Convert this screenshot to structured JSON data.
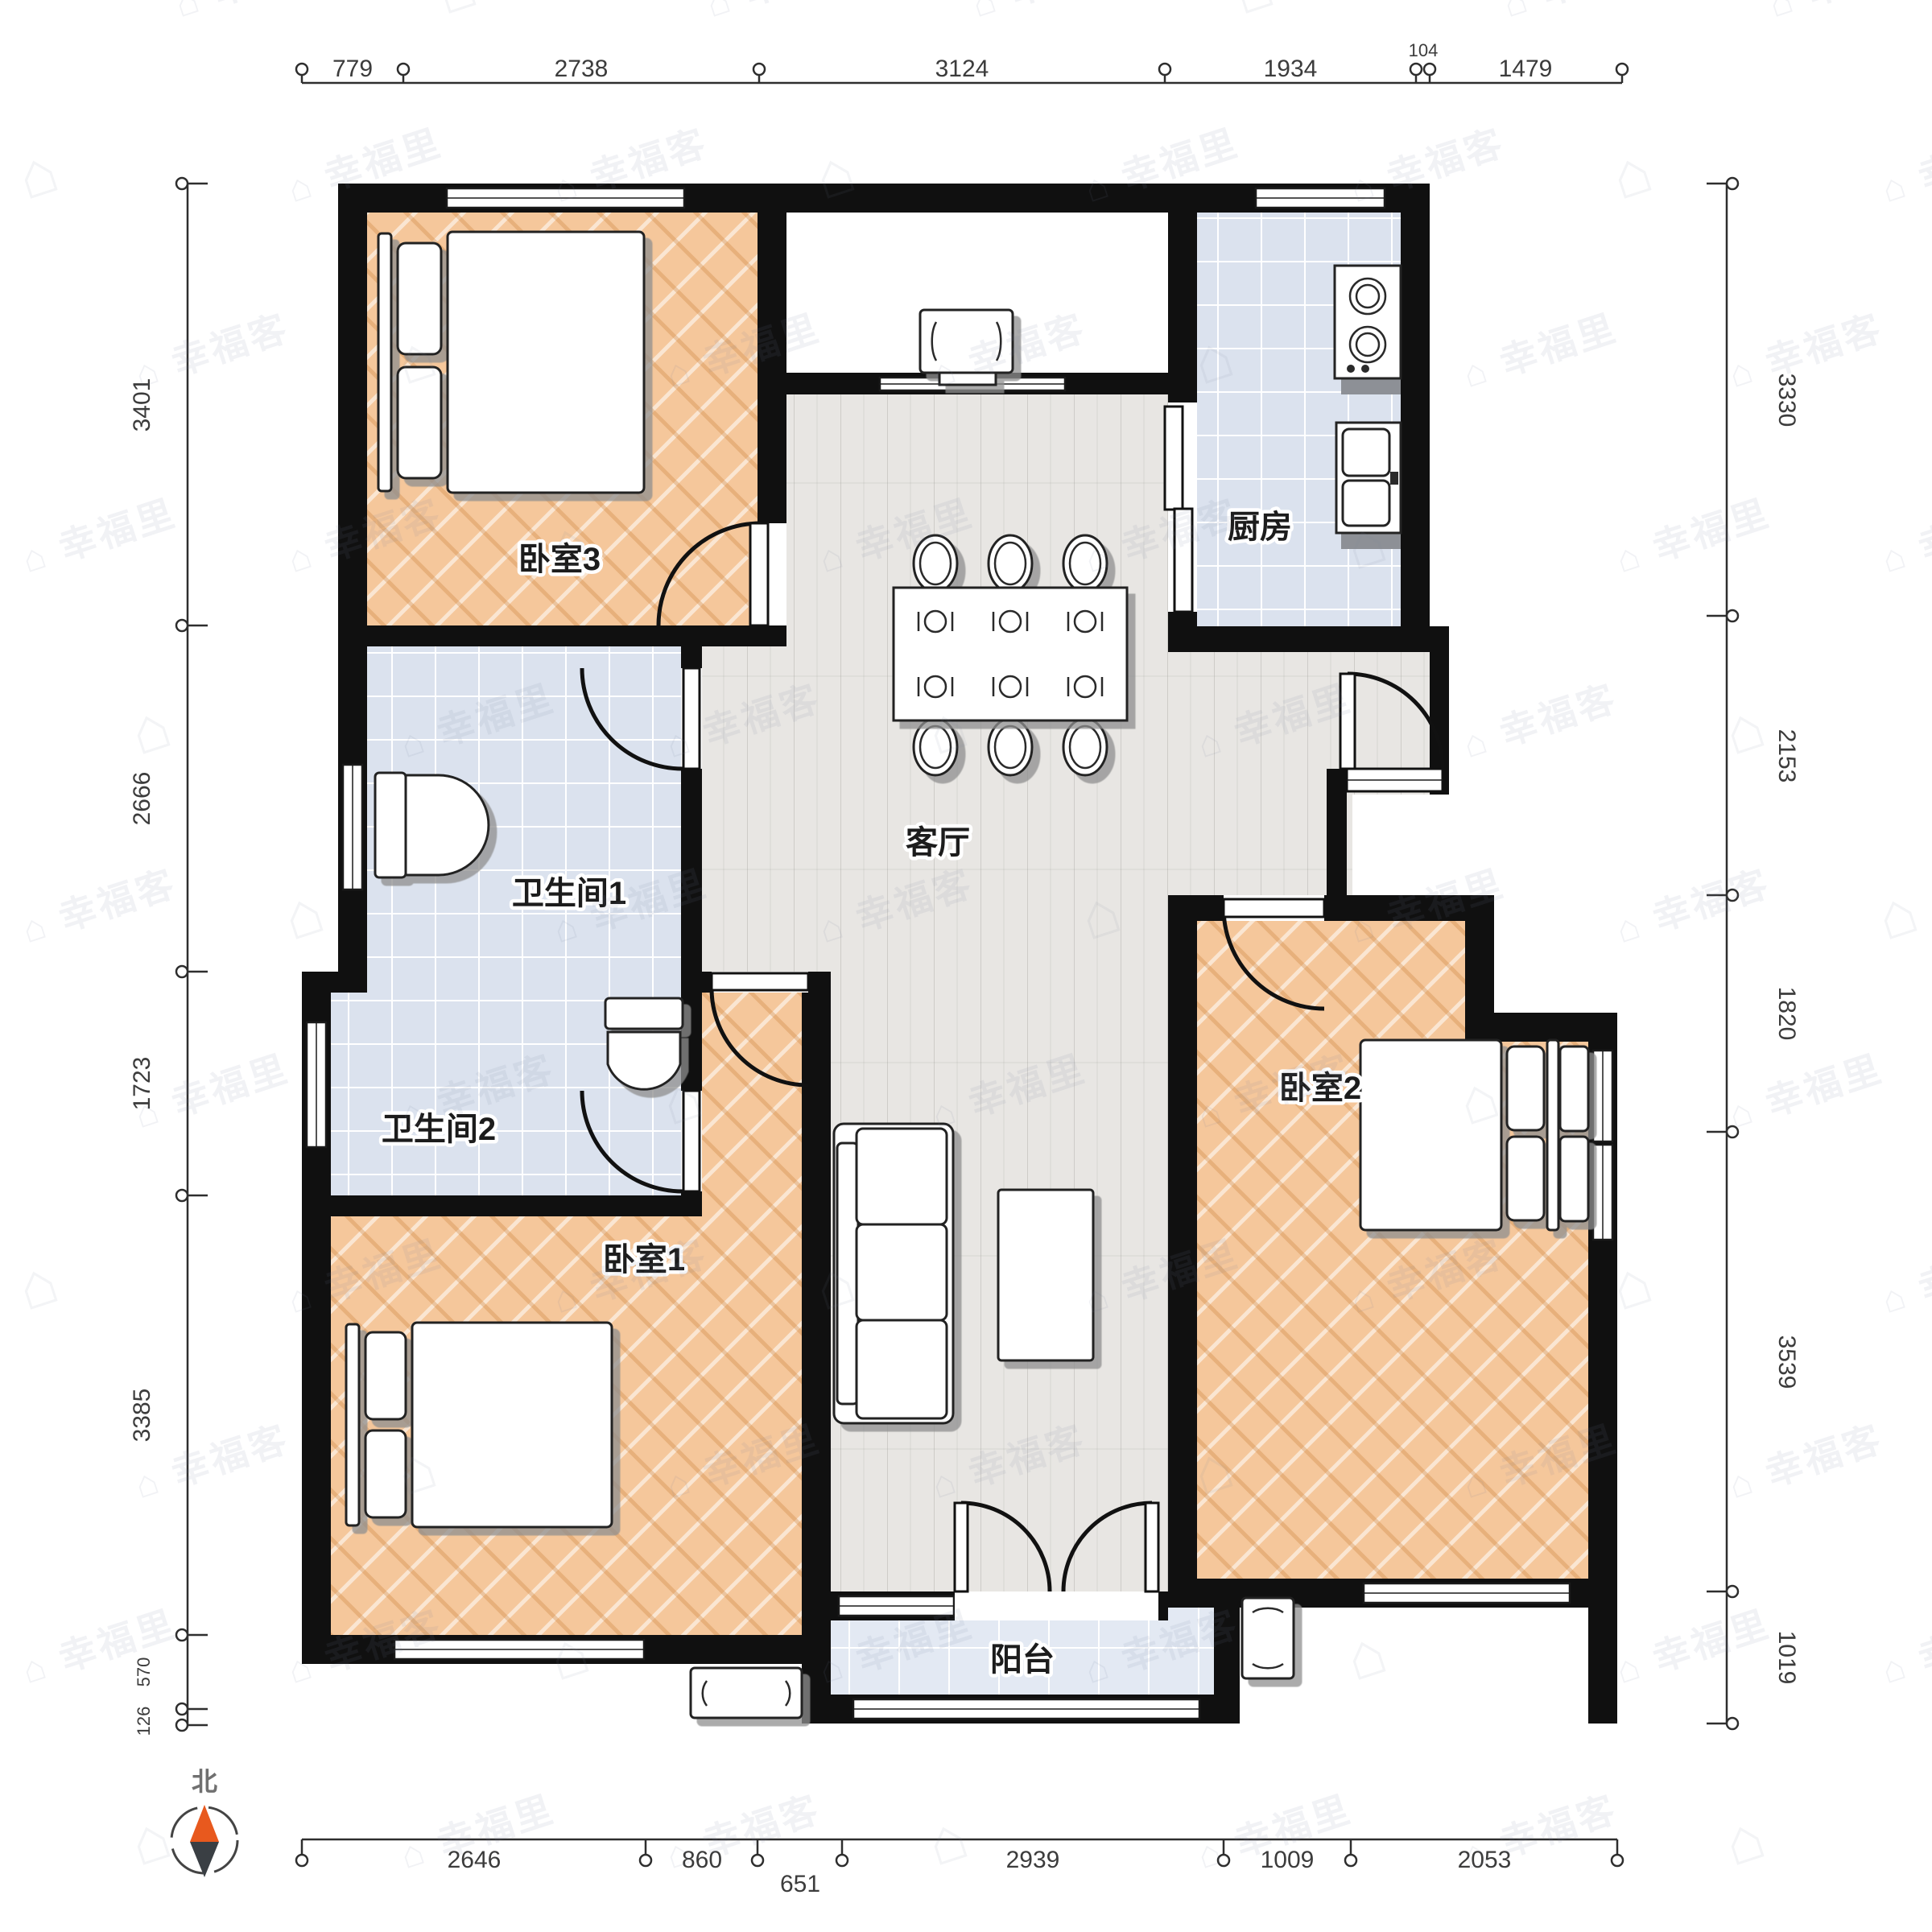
{
  "plan_type": "apartment-floor-plan",
  "rooms": {
    "bedroom3": {
      "label": "卧室3"
    },
    "kitchen": {
      "label": "厨房"
    },
    "bathroom1": {
      "label": "卫生间1"
    },
    "bathroom2": {
      "label": "卫生间2"
    },
    "living": {
      "label": "客厅"
    },
    "bedroom1": {
      "label": "卧室1"
    },
    "bedroom2": {
      "label": "卧室2"
    },
    "balcony": {
      "label": "阳台"
    }
  },
  "compass": {
    "label": "北"
  },
  "watermark": {
    "texts": [
      "幸福里",
      "幸福客"
    ],
    "logo_glyph": "⌂"
  },
  "dimensions": {
    "top": [
      "779",
      "2738",
      "3124",
      "1934",
      "104",
      "1479"
    ],
    "bottom": [
      "2646",
      "860",
      "651",
      "2939",
      "1009",
      "2053"
    ],
    "left": [
      "3401",
      "2666",
      "1723",
      "3385",
      "570",
      "126"
    ],
    "right": [
      "3330",
      "2153",
      "1820",
      "3539",
      "1019"
    ]
  },
  "furniture": [
    "double-bed-bedroom3",
    "double-bed-bedroom1",
    "double-bed-bedroom2",
    "nightstands",
    "toilet-bathroom1",
    "toilet-bathroom2",
    "stove-two-burners",
    "kitchen-sink",
    "dining-table-six-chairs",
    "sofa-three-seat",
    "coffee-table",
    "entry-cabinet",
    "balcony-side-cabinet",
    "outdoor-bench"
  ],
  "colors": {
    "wall": "#101010",
    "bedroom_floor": "#f5c79b",
    "bath_tile": "#dbe2ee",
    "kitchen_tile": "#dde4f0",
    "balcony_tile": "#e3e9f3",
    "living_wood": "#e8e6e3",
    "compass_north": "#e8591e",
    "compass_south": "#3a3f44"
  }
}
